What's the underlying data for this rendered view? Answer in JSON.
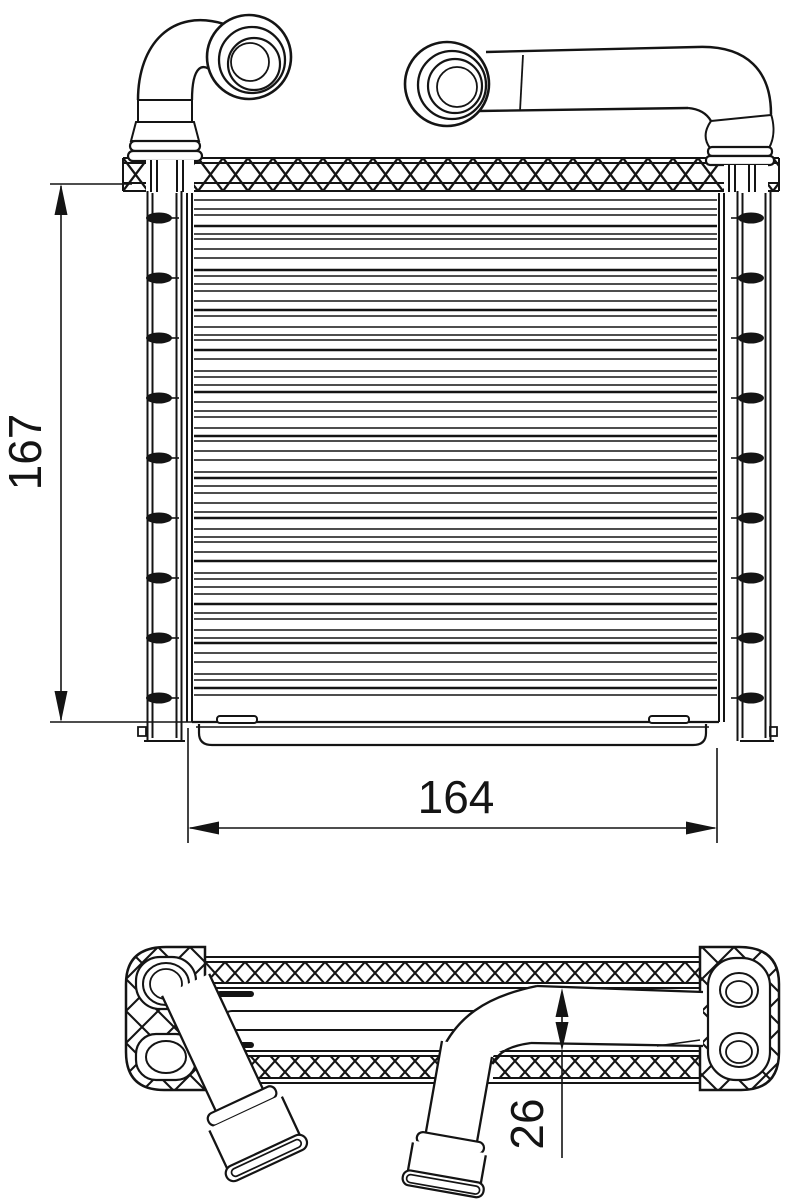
{
  "colors": {
    "ink": "#141414",
    "background": "#ffffff"
  },
  "dimensions": {
    "core_height": {
      "value": "167"
    },
    "core_width": {
      "value": "164"
    },
    "pipe_diameter": {
      "value": "26"
    }
  },
  "drawing": {
    "fin_line_count": 60,
    "tank_dimple_rows": 9,
    "dimple_spacing": 60,
    "dimple_start_y": 218
  }
}
